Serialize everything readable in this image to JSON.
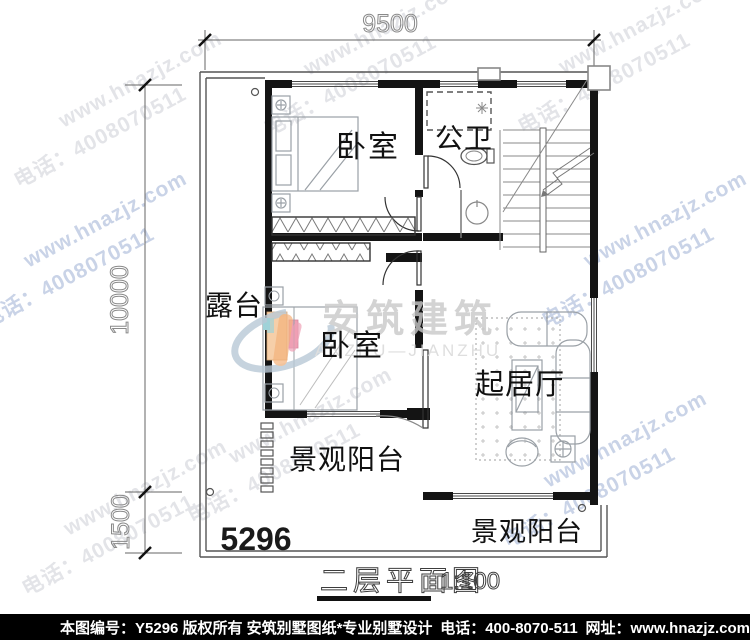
{
  "watermark": {
    "site": "www.hnazjz.com",
    "phone": "电话：4008070511",
    "gray": "#e3e4e8",
    "blue": "#c9d3e7"
  },
  "logo": {
    "name": "安筑建筑",
    "subtitle": "ANZHU—JIANZHU"
  },
  "dimensions": {
    "top": "9500",
    "left_main": "10000",
    "left_lower": "1500"
  },
  "rooms": {
    "bedroom_top": "卧室",
    "bedroom_bottom": "卧室",
    "bathroom": "公卫",
    "terrace": "露台",
    "living_room": "起居厅",
    "balcony_left": "景观阳台",
    "balcony_bottom": "景观阳台",
    "plan_number": "5296"
  },
  "title": {
    "name": "二层平面图",
    "scale": "1:100"
  },
  "footer": {
    "sheet_no": "本图编号：Y5296",
    "copyright": "版权所有",
    "brand": "安筑别墅图纸*专业别墅设计",
    "phone": "电话：400-8070-511",
    "site": "网址：www.hnazjz.com"
  },
  "colors": {
    "wall": "#141414",
    "footer_bg": "#000000",
    "footer_fg": "#ffffff",
    "swoosh": "#b9c9d6",
    "accent_orange": "#f3b37c",
    "accent_pink": "#ef9fb4",
    "accent_teal": "#9fd2d8"
  }
}
